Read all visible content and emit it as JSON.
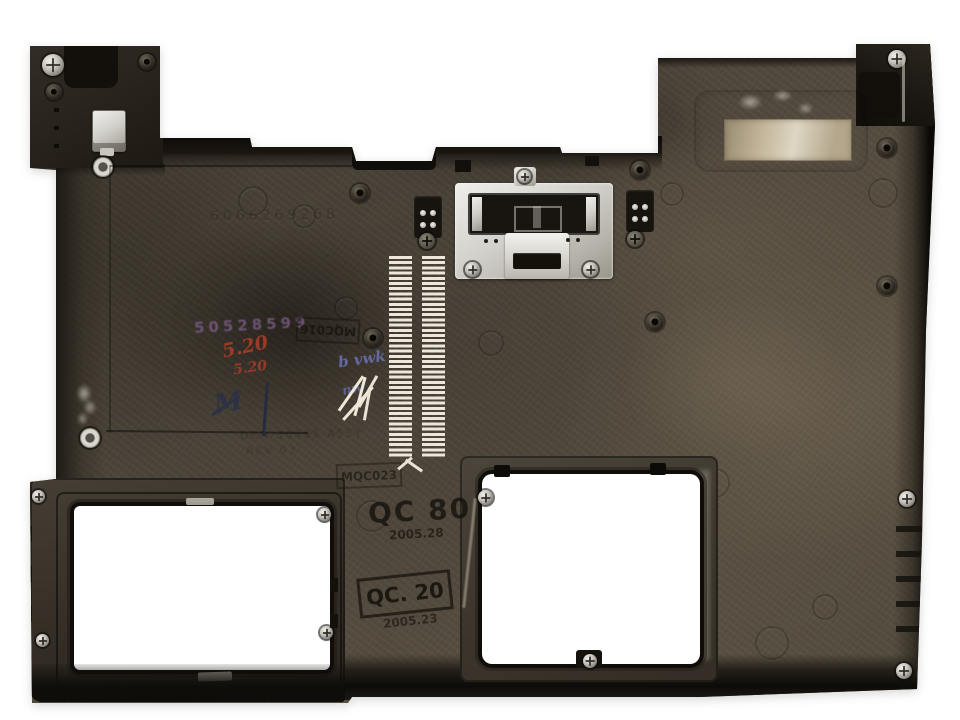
{
  "scene": {
    "type": "photograph",
    "subject": "Laptop bottom base enclosure (plastic chassis, inner underside view) on white background",
    "background_color": "#ffffff"
  },
  "features": {
    "openings": [
      "hdd-bay-opening",
      "memory-bay-opening"
    ],
    "vents": "two vertical vent slot columns",
    "bracket": "central metal latch bracket with screws",
    "label": "worn beige label residue, upper right"
  },
  "markings": {
    "embossed_serial": "6066269268",
    "purple_stamp": "50528599",
    "red_note_1": "5.20",
    "red_note_2": "5.20",
    "navy_scribble": "M",
    "blue_scribble_1": "b vwk",
    "blue_scribble_2": "nw",
    "stamp_mqc016": "MQC016",
    "stamp_mqc023": "MQC023",
    "stamp_qc80": "QC 80",
    "stamp_qc80_date": "2005.28",
    "stamp_qc20": "QC. 20",
    "stamp_qc20_date": "2005.23",
    "molded_line_1": "DCN-30495 A55Y",
    "molded_line_2": "REV 03"
  },
  "colors": {
    "plastic_base": "#4e463c",
    "plastic_dark_rim": "#17130e",
    "metal_silver": "#d6d3cc",
    "vent_slot": "#ece7da",
    "label_beige": "#c3b69a",
    "red_ink": "#9c3a28",
    "blue_ink": "#666ca6",
    "purple_ink": "#7a5d86",
    "navy_ink": "#2c3144",
    "white_scratch": "#eee8d8"
  }
}
